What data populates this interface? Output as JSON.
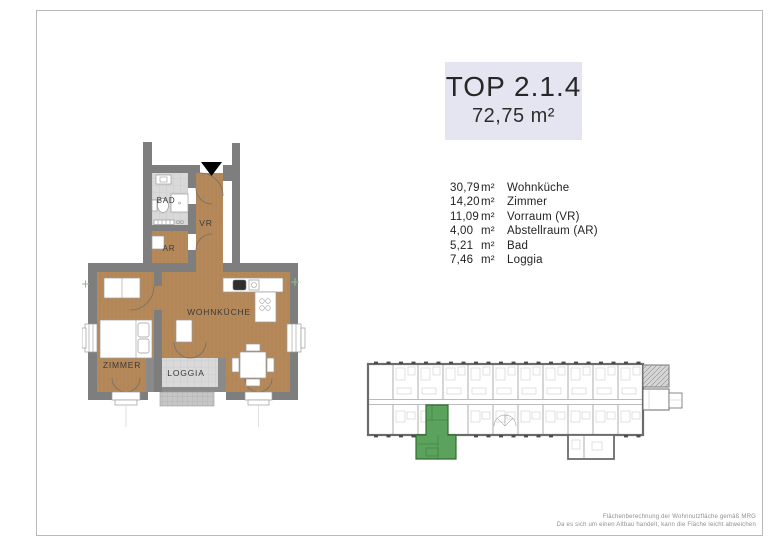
{
  "title_box": {
    "unit_label": "TOP 2.1.4",
    "total_area": "72,75 m²",
    "background": "#e5e5f1"
  },
  "room_list": {
    "rows": [
      {
        "area": "30,79",
        "unit": "m²",
        "name": "Wohnküche"
      },
      {
        "area": "14,20",
        "unit": "m²",
        "name": "Zimmer"
      },
      {
        "area": "11,09",
        "unit": "m²",
        "name": "Vorraum (VR)"
      },
      {
        "area": "4,00",
        "unit": "m²",
        "name": "Abstellraum (AR)"
      },
      {
        "area": "5,21",
        "unit": "m²",
        "name": "Bad"
      },
      {
        "area": "7,46",
        "unit": "m²",
        "name": "Loggia"
      }
    ]
  },
  "floor_plan": {
    "labels": {
      "bad": "BAD",
      "vr": "VR",
      "ar": "AR",
      "zimmer": "ZIMMER",
      "wohnkueche": "WOHNKÜCHE",
      "loggia": "LOGGIA"
    },
    "colors": {
      "wall": "#7e7e7e",
      "wood_floor": "#b6895a",
      "tile_floor": "#d9d9d9",
      "entrance_marker": "#000000"
    }
  },
  "overview": {
    "highlight_color": "#5ba25d",
    "outline_color": "#6b6b6b"
  },
  "footnote": {
    "line1": "Flächenberechnung der Wohnnutzfläche gemäß MRG",
    "line2": "Da es sich um einen Altbau handelt, kann die Fläche leicht abweichen"
  }
}
